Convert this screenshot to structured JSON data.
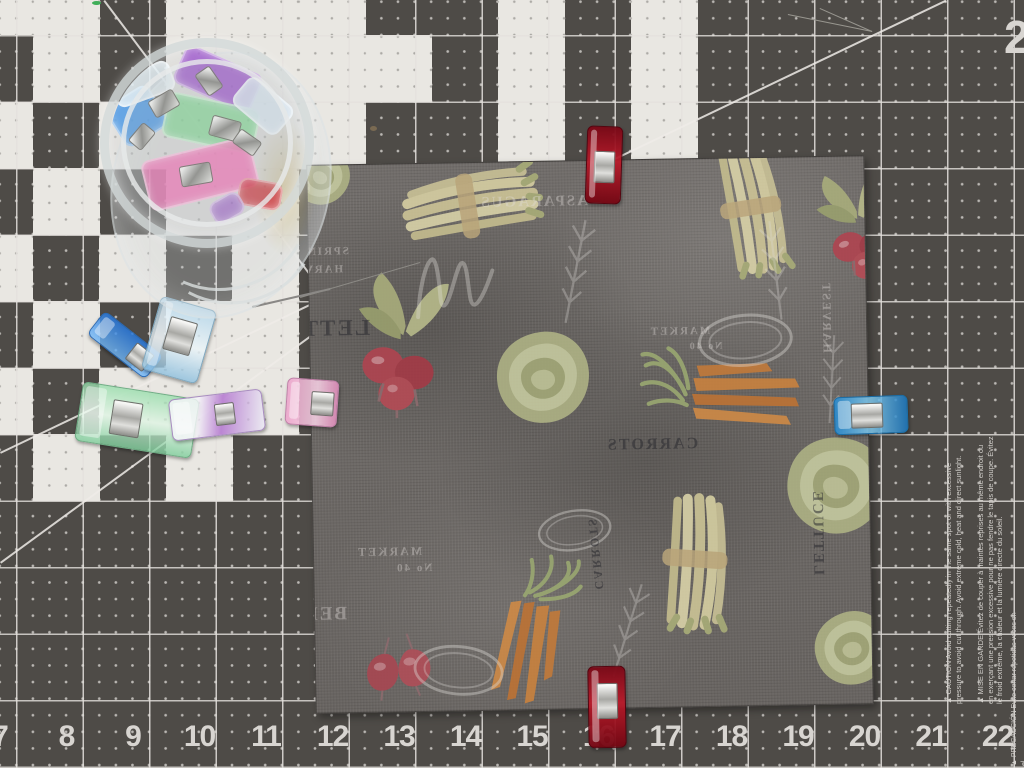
{
  "colors": {
    "mat_dark": "#4e4b47",
    "mat_white": "#e9e7e2",
    "grid_line": "#e4e1dd",
    "ruler_number": "#d8d5d1",
    "fabric_base": "#6d6966",
    "clip_red": "#a50f1e",
    "clip_blue": "#2a8cd2",
    "clip_pink": "#eca2ca",
    "clip_green": "#98deac",
    "clip_purple": "#9e52ca",
    "clip_teal": "#a8d2ec"
  },
  "mat": {
    "ruler_numbers": [
      "7",
      "8",
      "9",
      "10",
      "11",
      "12",
      "13",
      "14",
      "15",
      "16",
      "17",
      "18",
      "19",
      "20",
      "21",
      "22"
    ],
    "corner_digit": "2",
    "warnings": {
      "en": "▲ CAUTION Avoid cutting repeatedly in the same spot or with excessive pressure to avoid cut through. Avoid extreme cold, heat and direct sunlight.",
      "fr": "▲ MISE EN GARDE Évitez de couper à maintes reprises au même endroit ou en exerçant une pression excessive pour ne pas fendre le tapis de coupe. Évitez le froid extrême, la chaleur et la lumière directe du soleil.",
      "es_fragment": "▲ PRECAUCIÓN Evite cortar repetidas veces en el"
    },
    "white_cells": [
      [
        0,
        0
      ],
      [
        1,
        0
      ],
      [
        3,
        0
      ],
      [
        4,
        0
      ],
      [
        5,
        0
      ],
      [
        8,
        0
      ],
      [
        10,
        0
      ],
      [
        1,
        1
      ],
      [
        3,
        1
      ],
      [
        4,
        1
      ],
      [
        5,
        1
      ],
      [
        6,
        1
      ],
      [
        8,
        1
      ],
      [
        10,
        1
      ],
      [
        0,
        2
      ],
      [
        2,
        2
      ],
      [
        3,
        2
      ],
      [
        4,
        2
      ],
      [
        5,
        2
      ],
      [
        8,
        2
      ],
      [
        10,
        2
      ],
      [
        1,
        3
      ],
      [
        3,
        3
      ],
      [
        4,
        3
      ],
      [
        0,
        4
      ],
      [
        2,
        4
      ],
      [
        4,
        4
      ],
      [
        1,
        5
      ],
      [
        3,
        5
      ],
      [
        4,
        5
      ],
      [
        0,
        6
      ],
      [
        2,
        6
      ],
      [
        3,
        6
      ],
      [
        4,
        6
      ],
      [
        1,
        7
      ],
      [
        3,
        7
      ]
    ],
    "diagonals": [
      {
        "x1": 105,
        "y1": 0,
        "x2": 316,
        "y2": 281
      },
      {
        "x1": 0,
        "y1": 452,
        "x2": 945,
        "y2": 0
      },
      {
        "x1": 0,
        "y1": 562,
        "x2": 312,
        "y2": 334
      }
    ],
    "specks": [
      {
        "x": 370,
        "y": 126,
        "w": 7,
        "h": 5,
        "c": "#7a6a52"
      },
      {
        "x": 92,
        "y": 1,
        "w": 9,
        "h": 4,
        "c": "#3fae58"
      }
    ],
    "threads": [
      {
        "x1": 252,
        "y1": 306,
        "x2": 330,
        "y2": 288,
        "w": 2,
        "c": "#8a8886"
      },
      {
        "x1": 300,
        "y1": 297,
        "x2": 420,
        "y2": 262,
        "w": 1,
        "c": "#8d8b86"
      },
      {
        "x1": 788,
        "y1": 14,
        "x2": 872,
        "y2": 31,
        "w": 1.2,
        "c": "#98968f"
      },
      {
        "x1": 820,
        "y1": 8,
        "x2": 872,
        "y2": 31,
        "w": 1.2,
        "c": "#98968f"
      }
    ]
  },
  "fabric": {
    "labels": [
      {
        "text": "BEETS",
        "x": 6,
        "y": 26,
        "size": 20,
        "rot": 90
      },
      {
        "text": "SPRING",
        "x": 40,
        "y": 80,
        "size": 11,
        "rot": 0
      },
      {
        "text": "HARVEST",
        "x": 34,
        "y": 98,
        "size": 11,
        "rot": 0
      },
      {
        "text": "ASPARAGUS",
        "x": 280,
        "y": 32,
        "size": 15,
        "rot": 0
      },
      {
        "text": "LETTUCE",
        "x": 60,
        "y": 150,
        "size": 23,
        "rot": 0,
        "dark": true
      },
      {
        "text": "MARKET",
        "x": 400,
        "y": 166,
        "size": 11,
        "rot": 0
      },
      {
        "text": "No 40",
        "x": 412,
        "y": 182,
        "size": 10,
        "rot": 0
      },
      {
        "text": "MARKET",
        "x": 108,
        "y": 380,
        "size": 12,
        "rot": 0
      },
      {
        "text": "No 40",
        "x": 118,
        "y": 398,
        "size": 11,
        "rot": 0
      },
      {
        "text": "CARROTS",
        "x": 386,
        "y": 276,
        "size": 16,
        "rot": 0,
        "dark": true
      },
      {
        "text": "BEETS",
        "x": 32,
        "y": 438,
        "size": 19,
        "rot": 0
      },
      {
        "text": "HARVEST",
        "x": 524,
        "y": 196,
        "size": 12,
        "rot": 90
      },
      {
        "text": "LETTUCE",
        "x": 512,
        "y": 418,
        "size": 15,
        "rot": 90,
        "dark": true
      },
      {
        "text": "CARROTS",
        "x": 292,
        "y": 428,
        "size": 12,
        "rot": 85,
        "dark": true
      }
    ],
    "motifs": [
      {
        "type": "asparagus",
        "x": 75,
        "y": 0,
        "w": 175,
        "h": 85,
        "rot": -8
      },
      {
        "type": "asparagus",
        "x": 368,
        "y": 12,
        "w": 150,
        "h": 80,
        "rot": 82
      },
      {
        "type": "radish",
        "x": 28,
        "y": 100,
        "w": 130,
        "h": 155,
        "rot": 0
      },
      {
        "type": "lettuce",
        "x": 182,
        "y": 166,
        "w": 100,
        "h": 100,
        "rot": 0
      },
      {
        "type": "carrot",
        "x": 318,
        "y": 190,
        "w": 180,
        "h": 95,
        "rot": 6
      },
      {
        "type": "lettuce",
        "x": 470,
        "y": 276,
        "w": 106,
        "h": 106,
        "rot": 20
      },
      {
        "type": "asparagus",
        "x": 298,
        "y": 360,
        "w": 165,
        "h": 85,
        "rot": 95
      },
      {
        "type": "carrot",
        "x": 128,
        "y": 420,
        "w": 170,
        "h": 90,
        "rot": 105
      },
      {
        "type": "beets",
        "x": 36,
        "y": 468,
        "w": 100,
        "h": 70,
        "rot": -5
      },
      {
        "type": "radish",
        "x": 498,
        "y": 5,
        "w": 105,
        "h": 125,
        "rot": -18
      },
      {
        "type": "lettuce",
        "x": -18,
        "y": -20,
        "w": 62,
        "h": 62,
        "rot": 30
      },
      {
        "type": "lettuce",
        "x": 496,
        "y": 452,
        "w": 80,
        "h": 80,
        "rot": -10
      },
      {
        "type": "sprig",
        "x": 248,
        "y": 50,
        "w": 38,
        "h": 115,
        "rot": 12
      },
      {
        "type": "sprig",
        "x": 448,
        "y": 55,
        "w": 36,
        "h": 110,
        "rot": -6
      },
      {
        "type": "sprig",
        "x": 295,
        "y": 415,
        "w": 36,
        "h": 105,
        "rot": 18
      },
      {
        "type": "sprig",
        "x": 505,
        "y": 170,
        "w": 32,
        "h": 100,
        "rot": 4
      },
      {
        "type": "scriptm",
        "x": 100,
        "y": 78,
        "w": 90,
        "h": 85,
        "rot": -4
      },
      {
        "type": "stamp",
        "x": 385,
        "y": 152,
        "w": 100,
        "h": 60,
        "rot": -4
      },
      {
        "type": "stamp",
        "x": 95,
        "y": 478,
        "w": 95,
        "h": 58,
        "rot": 6
      },
      {
        "type": "stamp",
        "x": 222,
        "y": 344,
        "w": 78,
        "h": 50,
        "rot": -8
      }
    ]
  },
  "clips": [
    {
      "name": "red-clip-top",
      "variant": "red",
      "x": 586,
      "y": 126,
      "w": 36,
      "h": 78,
      "rot": 2,
      "metal": {
        "x": 7,
        "y": 24,
        "w": 21,
        "h": 32
      }
    },
    {
      "name": "red-clip-bottom",
      "variant": "red",
      "x": 588,
      "y": 666,
      "w": 38,
      "h": 82,
      "rot": -1,
      "metal": {
        "x": 8,
        "y": 16,
        "w": 21,
        "h": 36
      }
    },
    {
      "name": "blue-clip-right-edge",
      "variant": "blue",
      "x": 834,
      "y": 396,
      "w": 74,
      "h": 38,
      "rot": -2,
      "metal": {
        "x": 16,
        "y": 6,
        "w": 32,
        "h": 25
      }
    },
    {
      "name": "pink-clip-left-edge",
      "variant": "pink",
      "x": 286,
      "y": 379,
      "w": 52,
      "h": 47,
      "rot": 4,
      "metal": {
        "x": 24,
        "y": 11,
        "w": 23,
        "h": 24
      }
    },
    {
      "name": "blue-clip-scattered",
      "variant": "blue2",
      "x": 88,
      "y": 330,
      "w": 74,
      "h": 30,
      "rot": 38,
      "metal": {
        "x": 44,
        "y": 4,
        "w": 22,
        "h": 21
      }
    },
    {
      "name": "teal-clip-scattered",
      "variant": "teal",
      "x": 150,
      "y": 302,
      "w": 58,
      "h": 76,
      "rot": 16,
      "metal": {
        "x": 14,
        "y": 16,
        "w": 28,
        "h": 34
      }
    },
    {
      "name": "green-clip-scattered",
      "variant": "green",
      "x": 78,
      "y": 390,
      "w": 118,
      "h": 60,
      "rot": 9,
      "metal": {
        "x": 32,
        "y": 12,
        "w": 30,
        "h": 35
      }
    },
    {
      "name": "purple-clip-scattered",
      "variant": "purpleclear",
      "x": 170,
      "y": 394,
      "w": 94,
      "h": 42,
      "rot": -7,
      "metal": {
        "x": 44,
        "y": 9,
        "w": 20,
        "h": 22
      }
    }
  ],
  "jar": {
    "contents": [
      {
        "x": 66,
        "y": 10,
        "w": 84,
        "h": 42,
        "rot": 24,
        "c": "rgba(158,88,205,0.8)"
      },
      {
        "x": 2,
        "y": 44,
        "w": 50,
        "h": 48,
        "rot": -32,
        "c": "rgba(70,150,230,0.8)"
      },
      {
        "x": 54,
        "y": 52,
        "w": 94,
        "h": 46,
        "rot": 12,
        "c": "rgba(125,215,145,0.7)"
      },
      {
        "x": 34,
        "y": 100,
        "w": 112,
        "h": 52,
        "rot": -14,
        "c": "rgba(242,120,185,0.8)"
      },
      {
        "x": 2,
        "y": 20,
        "w": 62,
        "h": 32,
        "rot": -20,
        "c": "rgba(228,238,243,0.85)"
      },
      {
        "x": 124,
        "y": 40,
        "w": 58,
        "h": 36,
        "rot": 40,
        "c": "rgba(215,228,238,0.85)"
      },
      {
        "x": 128,
        "y": 132,
        "w": 44,
        "h": 28,
        "rot": 10,
        "c": "rgba(205,35,45,0.7)"
      },
      {
        "x": 100,
        "y": 148,
        "w": 34,
        "h": 24,
        "rot": -30,
        "c": "rgba(150,80,200,0.6)"
      }
    ],
    "metal_bits": [
      {
        "x": 40,
        "y": 46,
        "w": 28,
        "h": 19,
        "rot": -30
      },
      {
        "x": 100,
        "y": 70,
        "w": 30,
        "h": 21,
        "rot": 15
      },
      {
        "x": 70,
        "y": 116,
        "w": 32,
        "h": 21,
        "rot": -10
      },
      {
        "x": 124,
        "y": 86,
        "w": 26,
        "h": 17,
        "rot": 35
      },
      {
        "x": 20,
        "y": 80,
        "w": 24,
        "h": 17,
        "rot": -50
      },
      {
        "x": 86,
        "y": 24,
        "w": 26,
        "h": 18,
        "rot": 55
      }
    ]
  }
}
